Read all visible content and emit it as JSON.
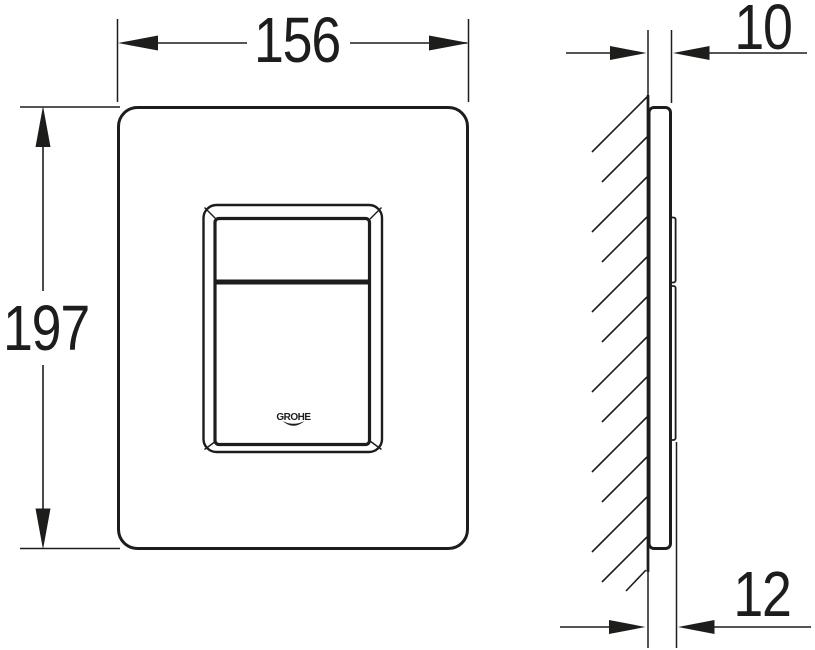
{
  "drawing": {
    "background_color": "#ffffff",
    "line_color": "#1d1d1b",
    "front_view": {
      "width_label": "156",
      "height_label": "197",
      "logo_text": "GROHE"
    },
    "side_view": {
      "top_thickness_label": "10",
      "bottom_thickness_label": "12"
    }
  }
}
